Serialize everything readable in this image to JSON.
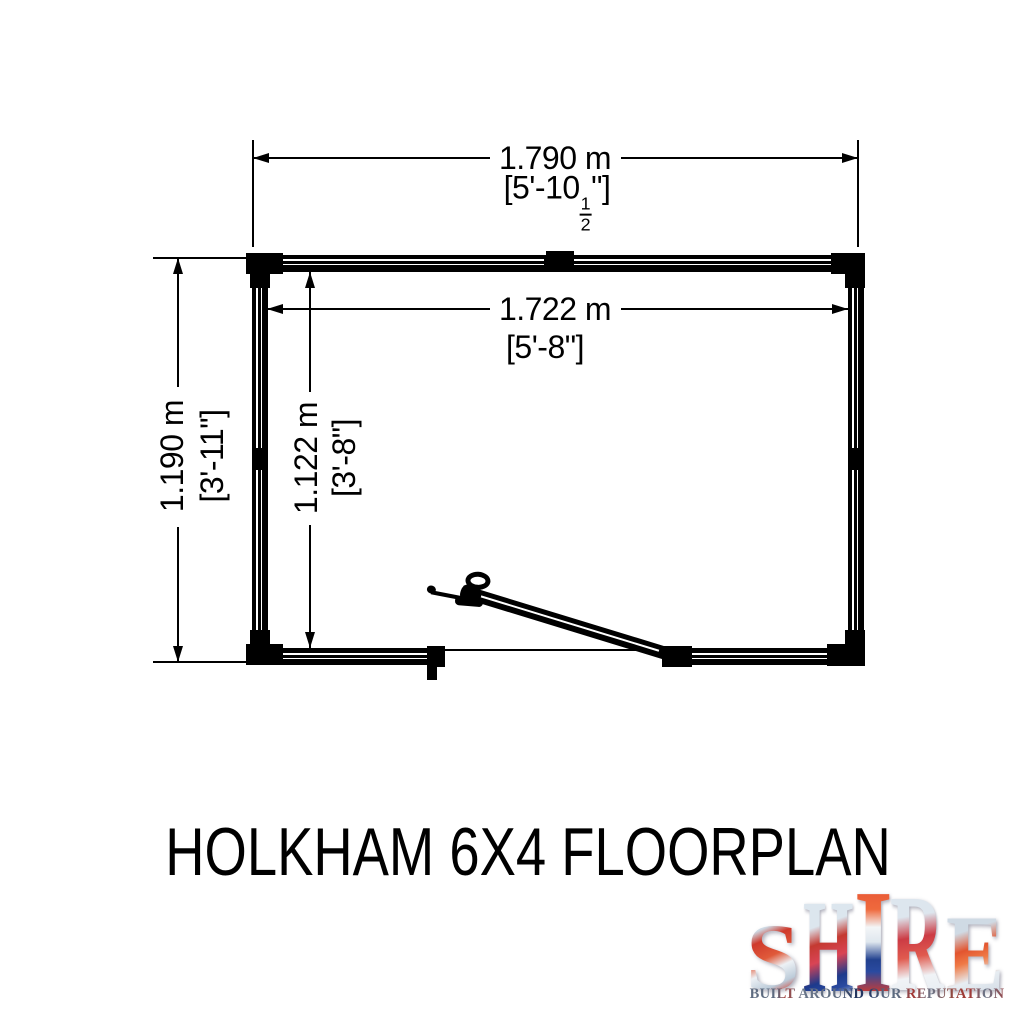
{
  "title": "HOLKHAM 6X4 FLOORPLAN",
  "dimensions": {
    "outer_width": {
      "metric": "1.790 m",
      "imperial_prefix": "[5'-10",
      "frac_numerator": "1",
      "frac_denominator": "2",
      "imperial_suffix": "\"]"
    },
    "inner_width": {
      "metric": "1.722 m",
      "imperial": "[5'-8\"]"
    },
    "outer_depth": {
      "metric": "1.190 m",
      "imperial": "[3'-11\"]"
    },
    "inner_depth": {
      "metric": "1.122 m",
      "imperial": "[3'-8\"]"
    }
  },
  "logo": {
    "brand": "SHIRE",
    "letters": [
      "S",
      "H",
      "I",
      "R",
      "E"
    ],
    "tagline": "BUILT AROUND OUR REPUTATION",
    "palette": {
      "red": "#c63b2e",
      "navy": "#1d3a8c",
      "silver": "#d9e2ea",
      "slate": "#5d6b80",
      "line": "#000000"
    }
  }
}
